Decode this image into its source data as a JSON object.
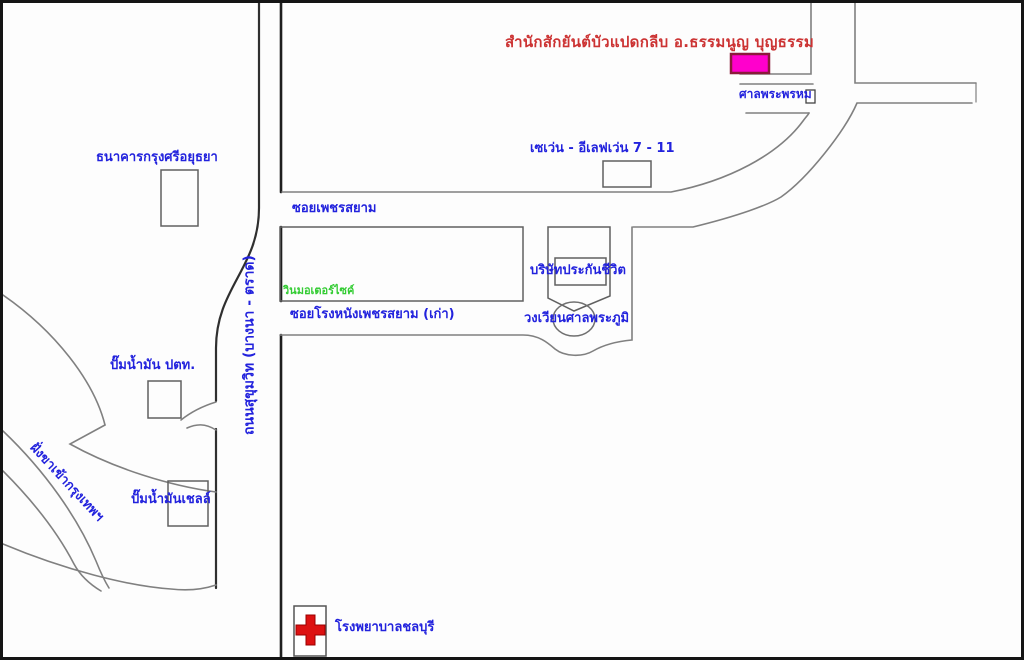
{
  "map": {
    "title": "สำนักสักยันต์บัวแปดกลีบ อ.ธรรมนูญ บุญธรรม",
    "labels": {
      "bank": "ธนาคารกรุงศรีอยุธยา",
      "seven_eleven": "เซเว่น - อีเลฟเว่น 7 - 11",
      "soi_phetsiam": "ซอยเพชรสยาม",
      "motorcycle_taxi": "วินมอเตอร์ไซค์",
      "insurance": "บริษัทประกันชีวิต",
      "roundabout": "วงเวียนศาลพระภูมิ",
      "soi_old_cinema": "ซอยโรงหนังเพชรสยาม (เก่า)",
      "brahma_shrine": "ศาลพระพรหม",
      "sukhumvit_road": "ถนนสุขุมวิท (บางนา - ตราด)",
      "ptt_station": "ปั๊มน้ำมัน ปตท.",
      "shell_station": "ปั๊มน้ำมันเชลล์",
      "ramp_direction": "ฝั่งขาเข้ากรุงเทพฯ",
      "hospital": "โรงพยาบาลชลบุรี"
    },
    "colors": {
      "label_blue": "#2222dd",
      "title_red": "#cc3333",
      "label_green": "#33cc33",
      "marker_magenta": "#ff00cc",
      "cross_red": "#dd1111",
      "road_gray": "#808080",
      "road_dark": "#1f1f1f",
      "background": "#fdfdfd"
    }
  }
}
